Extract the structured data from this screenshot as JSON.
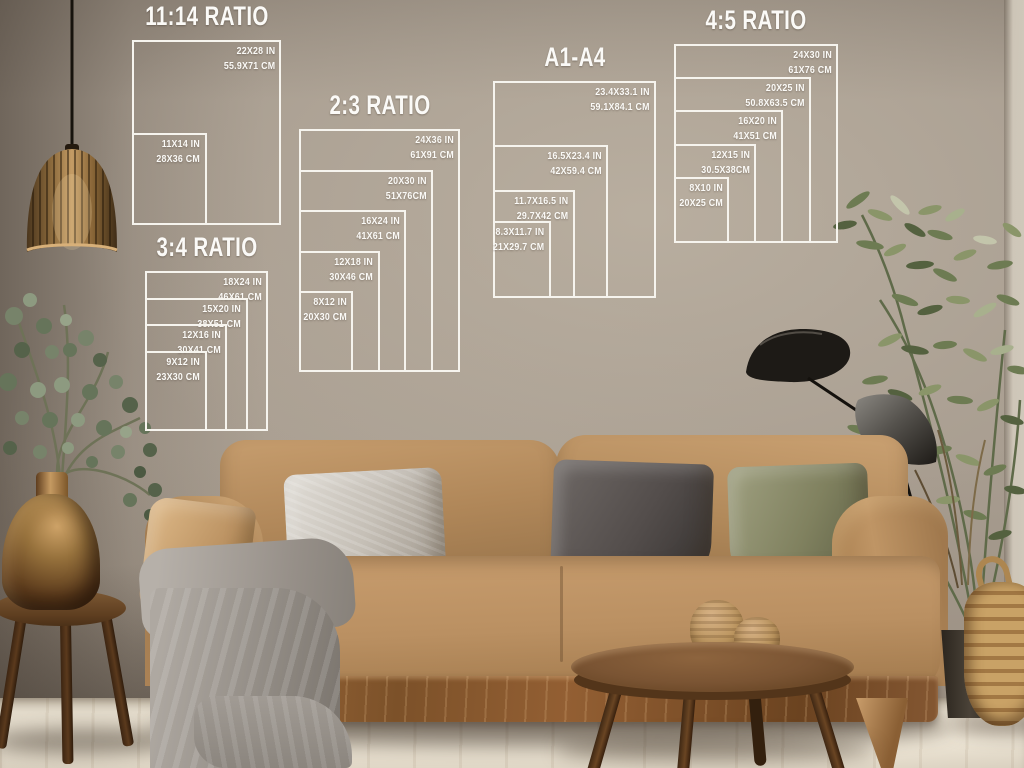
{
  "colors": {
    "overlay_line": "#f6f4ee",
    "overlay_text": "#fbfaf7",
    "wall": "#a89d90",
    "floor": "#e3dbcb",
    "sofa": "#b58c60",
    "wood": "#7a5433",
    "lamp_black": "#1d1a16",
    "plant_green": "#75835a",
    "copper": "#96713c"
  },
  "groups": [
    {
      "title": "11:14 RATIO",
      "sizes": [
        {
          "inches": "22X28 IN",
          "cm": "55.9X71 CM",
          "w": 22,
          "h": 28
        },
        {
          "inches": "11X14 IN",
          "cm": "28X36 CM",
          "w": 11,
          "h": 14
        }
      ]
    },
    {
      "title": "2:3 RATIO",
      "sizes": [
        {
          "inches": "24X36 IN",
          "cm": "61X91 CM",
          "w": 24,
          "h": 36
        },
        {
          "inches": "20X30 IN",
          "cm": "51X76CM",
          "w": 20,
          "h": 30
        },
        {
          "inches": "16X24 IN",
          "cm": "41X61 CM",
          "w": 16,
          "h": 24
        },
        {
          "inches": "12X18 IN",
          "cm": "30X46 CM",
          "w": 12,
          "h": 18
        },
        {
          "inches": "8X12 IN",
          "cm": "20X30 CM",
          "w": 8,
          "h": 12
        }
      ]
    },
    {
      "title": "A1-A4",
      "sizes": [
        {
          "inches": "23.4X33.1 IN",
          "cm": "59.1X84.1 CM",
          "w": 23.4,
          "h": 33.1
        },
        {
          "inches": "16.5X23.4 IN",
          "cm": "42X59.4 CM",
          "w": 16.5,
          "h": 23.4
        },
        {
          "inches": "11.7X16.5 IN",
          "cm": "29.7X42 CM",
          "w": 11.7,
          "h": 16.5
        },
        {
          "inches": "8.3X11.7 IN",
          "cm": "21X29.7 CM",
          "w": 8.3,
          "h": 11.7
        }
      ]
    },
    {
      "title": "4:5 RATIO",
      "sizes": [
        {
          "inches": "24X30 IN",
          "cm": "61X76 CM",
          "w": 24,
          "h": 30
        },
        {
          "inches": "20X25 IN",
          "cm": "50.8X63.5 CM",
          "w": 20,
          "h": 25
        },
        {
          "inches": "16X20 IN",
          "cm": "41X51 CM",
          "w": 16,
          "h": 20
        },
        {
          "inches": "12X15 IN",
          "cm": "30.5X38CM",
          "w": 12,
          "h": 15
        },
        {
          "inches": "8X10 IN",
          "cm": "20X25 CM",
          "w": 8,
          "h": 10
        }
      ]
    },
    {
      "title": "3:4 RATIO",
      "sizes": [
        {
          "inches": "18X24 IN",
          "cm": "46X61 CM",
          "w": 18,
          "h": 24
        },
        {
          "inches": "15X20 IN",
          "cm": "38X51 CM",
          "w": 15,
          "h": 20
        },
        {
          "inches": "12X16 IN",
          "cm": "30X41 CM",
          "w": 12,
          "h": 16
        },
        {
          "inches": "9X12 IN",
          "cm": "23X30 CM",
          "w": 9,
          "h": 12
        }
      ]
    }
  ],
  "scene": {
    "objects": [
      "pendant-lamp",
      "eucalyptus-plant",
      "copper-vase",
      "wooden-stool",
      "velvet-sofa",
      "throw-blanket",
      "silver-pillow",
      "dark-gray-pillow",
      "olive-pillow",
      "tan-pillow",
      "coffee-table",
      "jute-vases",
      "black-floor-lamp",
      "potted-plant",
      "wicker-basket"
    ]
  }
}
